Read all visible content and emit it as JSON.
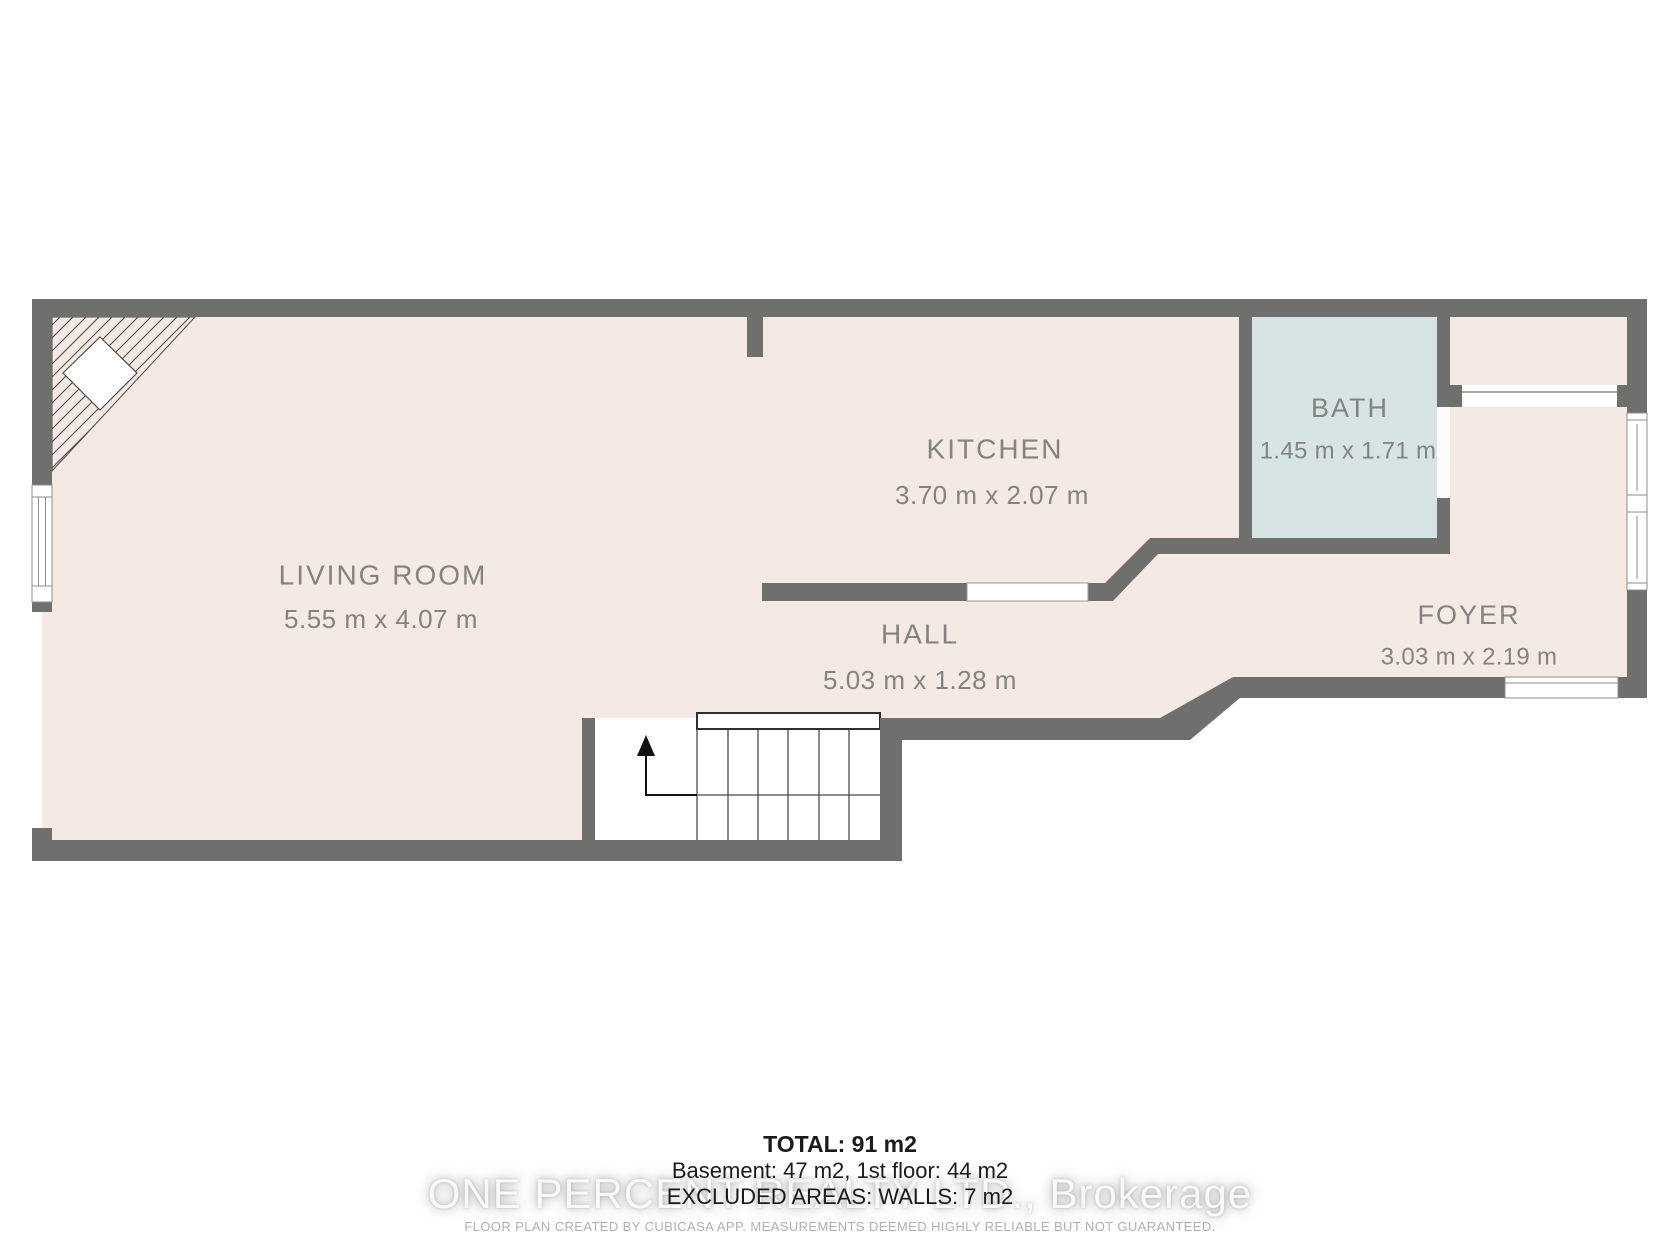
{
  "title": "Floor plan",
  "colors": {
    "background": "#ffffff",
    "floor": "#f4e9e3",
    "bath_floor": "#d7e4e5",
    "wall": "#6f706e",
    "room_label": "#838380",
    "footer_text": "#1b1b1b",
    "fine_print": "#b2b0af"
  },
  "rooms": [
    {
      "id": "living-room",
      "name": "LIVING ROOM",
      "dimensions": "5.55 m x 4.07 m"
    },
    {
      "id": "kitchen",
      "name": "KITCHEN",
      "dimensions": "3.70 m x 2.07 m"
    },
    {
      "id": "hall",
      "name": "HALL",
      "dimensions": "5.03 m x 1.28 m"
    },
    {
      "id": "bath",
      "name": "BATH",
      "dimensions": "1.45 m x 1.71 m"
    },
    {
      "id": "foyer",
      "name": "FOYER",
      "dimensions": "3.03 m x 2.19 m"
    }
  ],
  "summary": {
    "total": "TOTAL: 91 m2",
    "floors": "Basement: 47 m2, 1st floor: 44 m2",
    "excluded": "EXCLUDED AREAS: WALLS: 7 m2"
  },
  "watermark": "ONE PERCENT REALTY LTD., Brokerage",
  "disclaimer": "FLOOR PLAN CREATED BY CUBICASA APP. MEASUREMENTS DEEMED HIGHLY RELIABLE BUT NOT GUARANTEED."
}
